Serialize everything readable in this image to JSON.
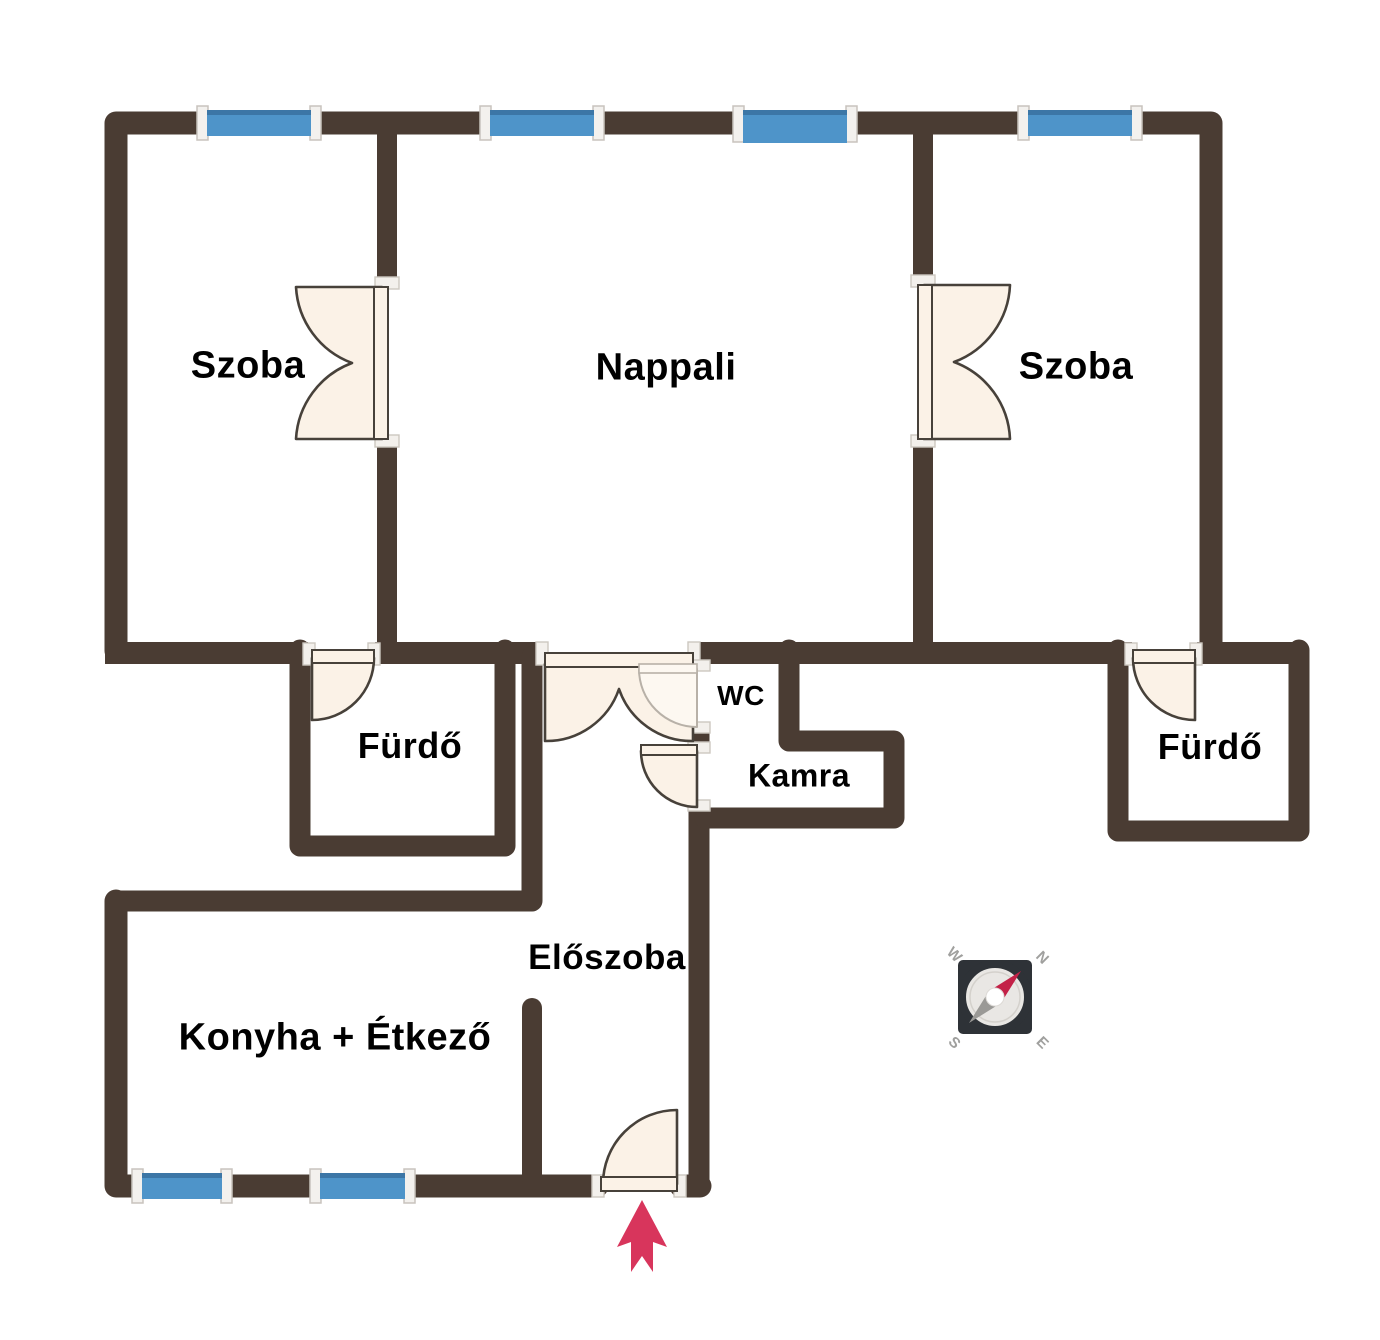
{
  "rooms": [
    {
      "id": "szoba-left",
      "label": "Szoba"
    },
    {
      "id": "nappali",
      "label": "Nappali"
    },
    {
      "id": "szoba-right",
      "label": "Szoba"
    },
    {
      "id": "furdo-left",
      "label": "Fürdő"
    },
    {
      "id": "wc",
      "label": "WC"
    },
    {
      "id": "kamra",
      "label": "Kamra"
    },
    {
      "id": "furdo-right",
      "label": "Fürdő"
    },
    {
      "id": "eloszoba",
      "label": "Előszoba"
    },
    {
      "id": "konyha",
      "label": "Konyha + Étkező"
    }
  ],
  "compass": {
    "n": "N",
    "e": "E",
    "s": "S",
    "w": "W"
  },
  "colors": {
    "wall": "#4a3c33",
    "window_blue": "#4e94c9",
    "window_blue_dark": "#3c76a6",
    "window_cap": "#f3f1ee",
    "cap_border": "#c8c3bd",
    "door_fill": "#fbf2e7",
    "door_outline": "#47413a",
    "door_faint": "#b8b1a8",
    "door_faint_fill": "#fdf8f1",
    "frame_fill": "#f3f0ec",
    "frame_border": "#ccc7c0",
    "arrow": "#d8355c",
    "compass_dark": "#2e3237",
    "compass_inner": "#e9e7e4",
    "compass_inner_border": "#d4d1cc",
    "compass_red": "#c32147",
    "compass_gray": "#9a9996",
    "compass_letter": "#a0a09e",
    "label_color": "#000000",
    "bg": "#ffffff"
  }
}
